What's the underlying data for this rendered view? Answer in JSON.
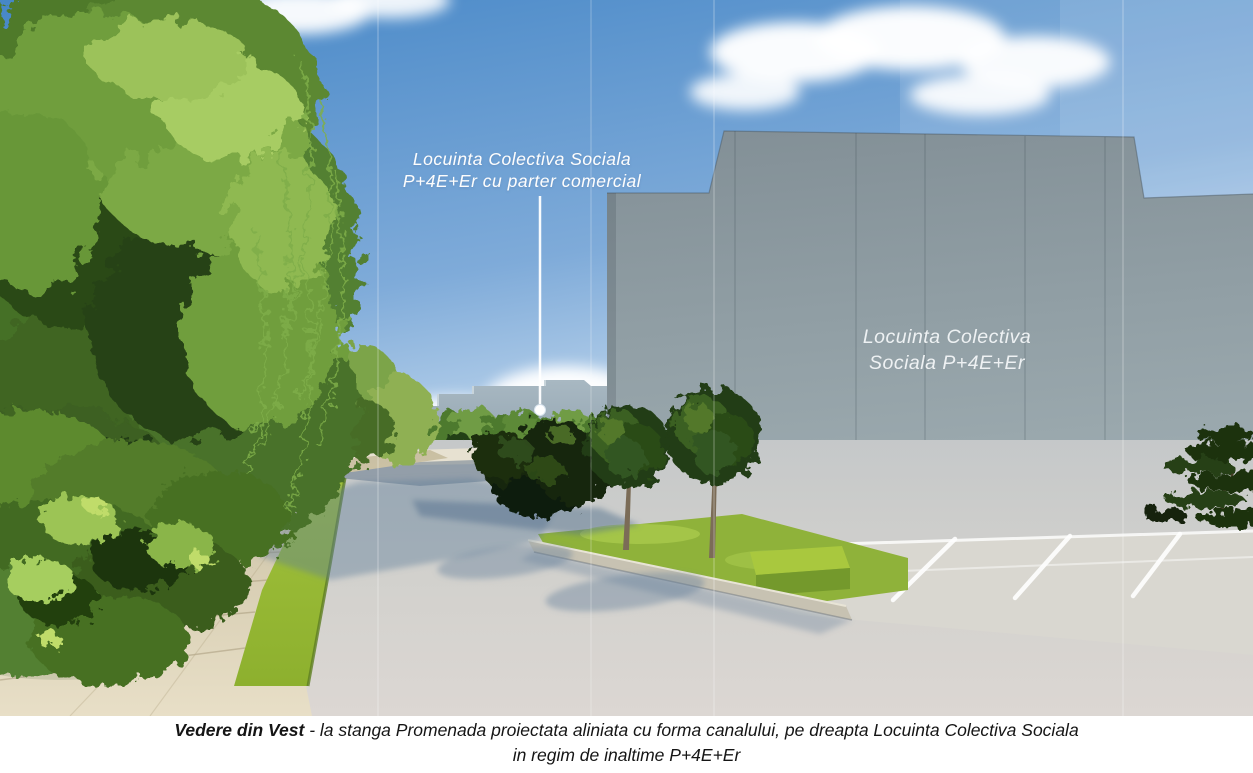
{
  "figure": {
    "sky_annotation": {
      "line1": "Locuinta Colectiva Sociala",
      "line2": "P+4E+Er cu parter comercial"
    },
    "building_label": {
      "line1": "Locuinta Colectiva",
      "line2": "Sociala P+4E+Er"
    },
    "caption": {
      "title": "Vedere din Vest",
      "rest": " - la stanga Promenada proiectata aliniata cu forma canalului, pe dreapta Locuinta Colectiva Sociala",
      "line2": "in regim de inaltime P+4E+Er"
    },
    "colors": {
      "sky_top": "#4687c7",
      "sky_horizon": "#dde9f6",
      "main_building_facade": "#8b99a0",
      "distant_building": "#a8b8c2",
      "canal_water": "#3c6080",
      "hedge_dark": "#1e2c16",
      "grass_green": "#a2c23c",
      "willow_green": "#7ba944",
      "promenade_beige": "#d9d0b8",
      "road_gray": "#cfd0cd",
      "parking_gray": "#d9d7d0",
      "annotation_text": "#ffffff",
      "caption_text": "#151515"
    }
  }
}
